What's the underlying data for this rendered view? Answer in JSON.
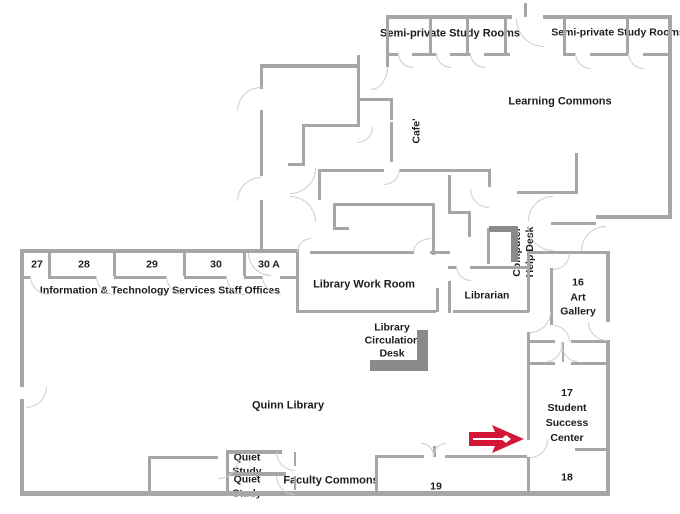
{
  "colors": {
    "wall": "#a6a6a6",
    "desk_fill": "#8a8a8a",
    "arrow_red": "#d31638",
    "text": "#1c1c1c",
    "background": "#ffffff"
  },
  "rooms": {
    "semi_private_left": "Semi-private Study Rooms",
    "semi_private_right": "Semi-private Study Rooms",
    "learning_commons": "Learning Commons",
    "cafe": "Cafe'",
    "library_work_room": "Library Work Room",
    "librarian": "Librarian",
    "computer_help_desk": [
      "Computer",
      "Help Desk"
    ],
    "it_office_numbers": [
      "27",
      "28",
      "29",
      "30",
      "30 A"
    ],
    "it_offices_label": "Information & Technology Services Staff Offices",
    "circulation_desk": [
      "Library",
      "Circulation",
      "Desk"
    ],
    "art_gallery": [
      "16",
      "Art",
      "Gallery"
    ],
    "quinn_library": "Quinn Library",
    "student_success_center": [
      "17",
      "Student",
      "Success",
      "Center"
    ],
    "room_18": "18",
    "room_19": "19",
    "quiet_study_upper": [
      "Quiet",
      "Study"
    ],
    "quiet_study_lower": [
      "Quiet",
      "Study"
    ],
    "faculty_commons": "Faculty Commons"
  },
  "marker": {
    "icon": "location-arrow-icon",
    "description": "red arrow pointing right toward Student Success Center entrance"
  }
}
